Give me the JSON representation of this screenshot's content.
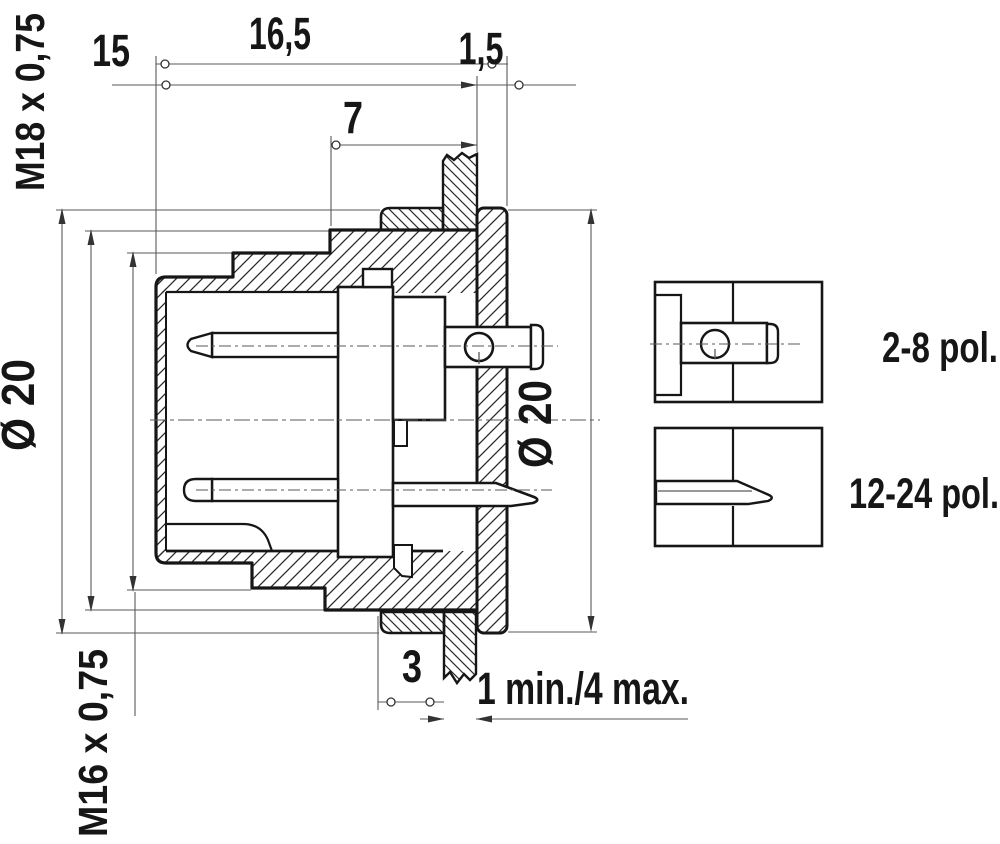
{
  "drawing": {
    "dims": {
      "total_length": "16,5",
      "length_to_flange": "15",
      "flange_thickness": "1,5",
      "thread_length": "7",
      "top_left_thread": "M18 x 0,75",
      "bottom_left_thread": "M16 x 0,75",
      "left_diameter": "Ø 20",
      "right_diameter": "Ø 20",
      "nut_thickness": "3",
      "panel_thickness_range": "1 min./4 max."
    },
    "variants": {
      "round_contact": "2-8 pol.",
      "flat_contact": "12-24 pol."
    },
    "colors": {
      "line": "#161616",
      "thin_line": "#5a5a5a",
      "background": "#ffffff"
    }
  }
}
